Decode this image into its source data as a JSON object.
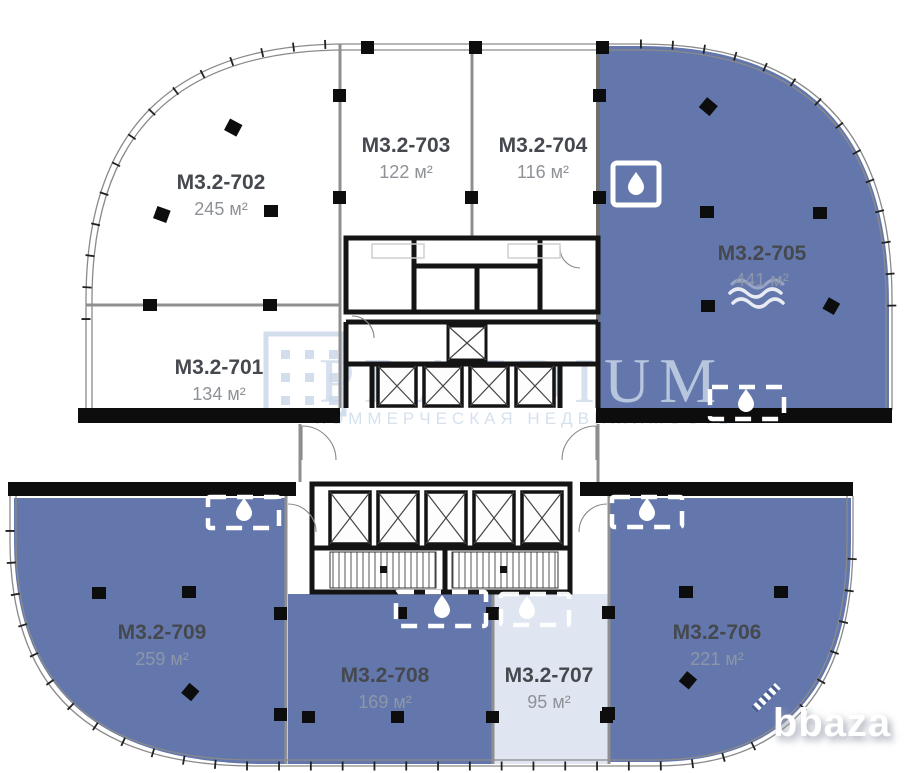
{
  "plan": {
    "title": "Floor plan with office units",
    "units": [
      {
        "code": "M3.2-701",
        "area": "134 м²",
        "status_fill": "white"
      },
      {
        "code": "M3.2-702",
        "area": "245 м²",
        "status_fill": "white"
      },
      {
        "code": "M3.2-703",
        "area": "122 м²",
        "status_fill": "white"
      },
      {
        "code": "M3.2-704",
        "area": "116 м²",
        "status_fill": "white"
      },
      {
        "code": "M3.2-705",
        "area": "441 м²",
        "status_fill": "blue",
        "feature": "water-supply"
      },
      {
        "code": "M3.2-706",
        "area": "221 м²",
        "status_fill": "blue"
      },
      {
        "code": "M3.2-707",
        "area": "95 м²",
        "status_fill": "light"
      },
      {
        "code": "M3.2-708",
        "area": "169 м²",
        "status_fill": "blue"
      },
      {
        "code": "M3.2-709",
        "area": "259 м²",
        "status_fill": "blue"
      }
    ],
    "icons": {
      "water_drop": "water-drop",
      "waves": "waves"
    }
  },
  "watermark": {
    "brand": "PRAEDIUM",
    "tagline": "КОММЕРЧЕСКАЯ НЕДВИЖИМОСТЬ"
  },
  "site_logo": {
    "text": "bbaza"
  },
  "colors": {
    "unit_blue": "#6377ac",
    "unit_light": "#dfe6f2",
    "unit_white": "#ffffff",
    "wall_black": "#141414",
    "wall_gray": "#8f8f8f",
    "title_text": "#45494f",
    "area_text": "#8e9297",
    "watermark_blue": "#ccd9ea",
    "column_black": "#0d0d0d",
    "icon_white": "#ffffff"
  }
}
